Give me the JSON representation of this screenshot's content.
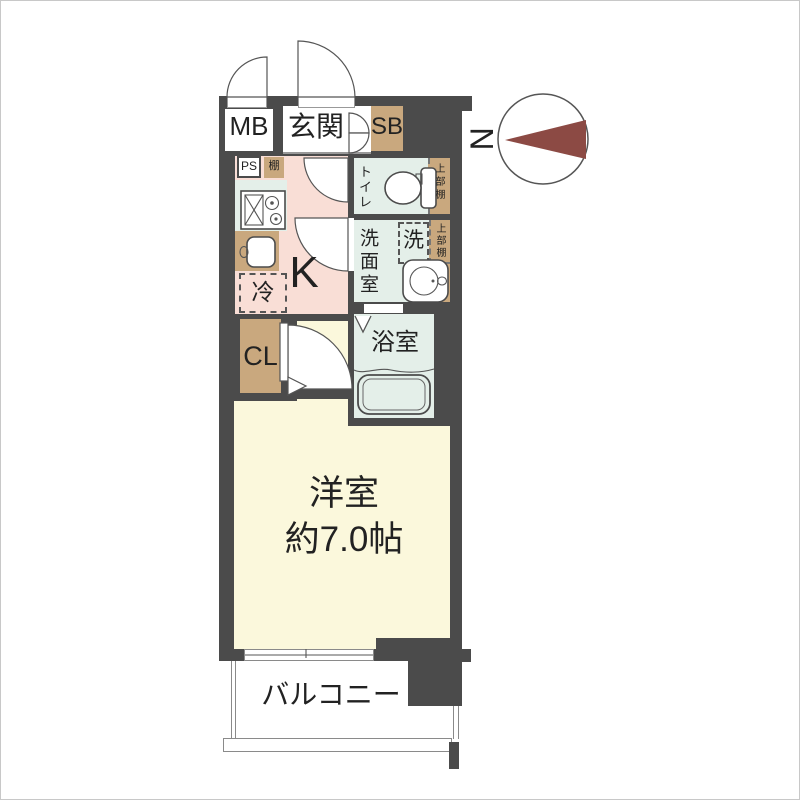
{
  "title": "apartment-floor-plan",
  "compass": {
    "north_label": "N"
  },
  "labels": {
    "mb": "MB",
    "entrance": "玄関",
    "shoe_box": "SB",
    "pipe_space": "PS",
    "shelf": "棚",
    "toilet": "トイレ",
    "toilet_upper_shelf": "上部棚",
    "washroom": "洗面室",
    "washing_machine": "洗",
    "washroom_upper_shelf": "上部棚",
    "refrigerator": "冷",
    "kitchen": "K",
    "closet": "CL",
    "bathroom": "浴室",
    "western_room": "洋室",
    "western_room_size": "約7.0帖",
    "balcony": "バルコニー"
  },
  "colors": {
    "wall": "#4b4b4b",
    "storage_tan": "#c9a87e",
    "kitchen_pink": "#f9ded6",
    "wet_area_mint": "#e4efe9",
    "room_cream": "#fbf8dc",
    "compass_needle": "#8c4a44"
  }
}
